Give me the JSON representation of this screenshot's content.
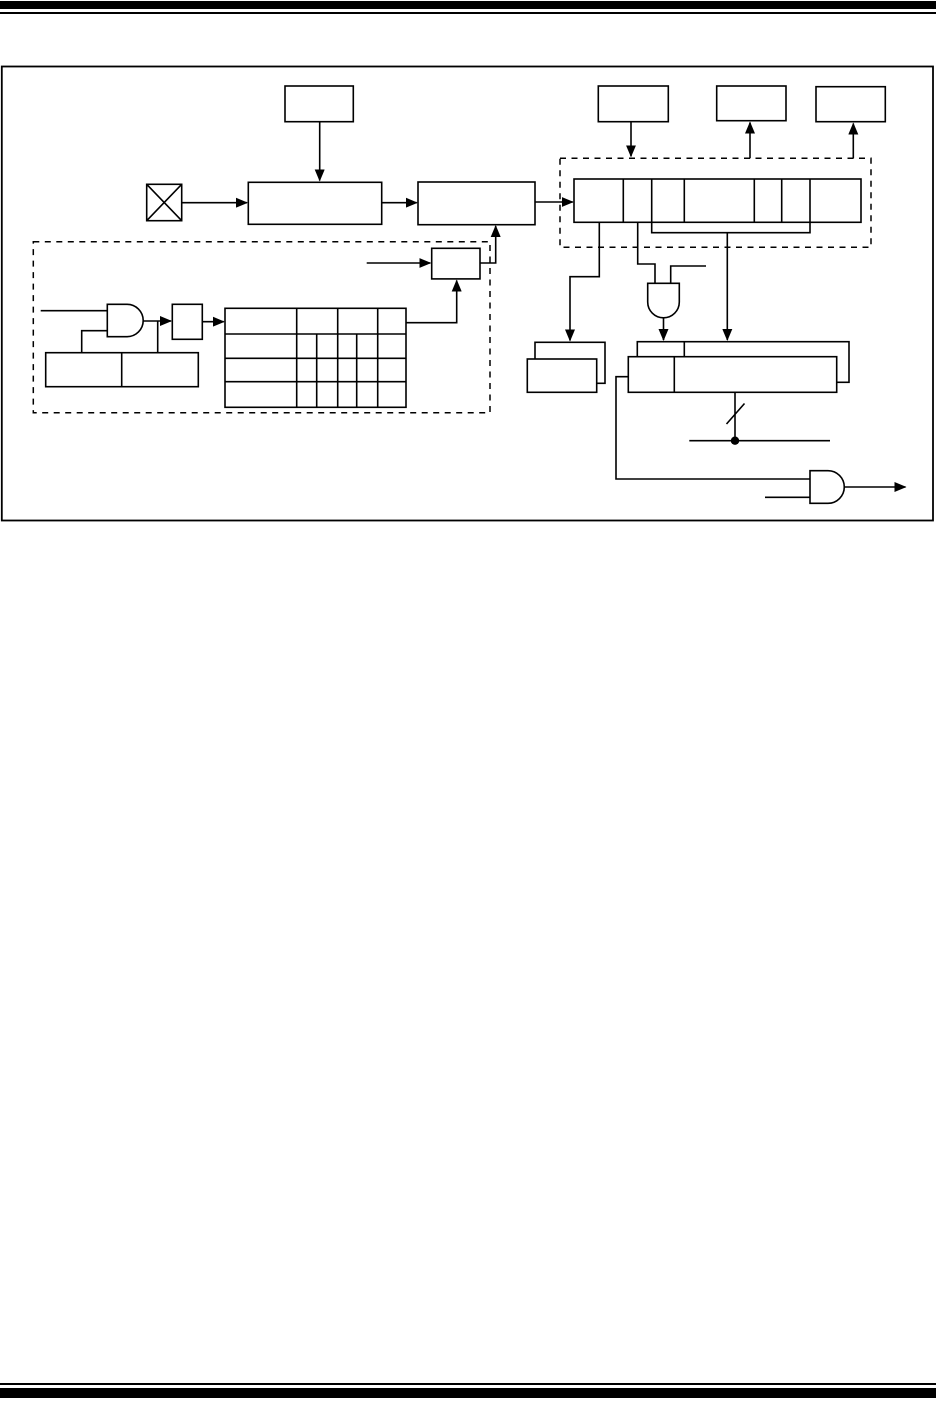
{
  "page": {
    "kind": "datasheet-figure-page",
    "visible_text": []
  },
  "colors": {
    "page_background": "#ffffff",
    "line_color": "#000000",
    "rule_color": "#000000"
  },
  "header": {
    "rules": [
      "thick-bar",
      "thin-rule"
    ]
  },
  "footer": {
    "rules": [
      "thin-rule",
      "thick-bar"
    ]
  },
  "figure": {
    "type": "block-diagram",
    "border": "solid-rectangle",
    "text_labels": [],
    "components": [
      {
        "name": "top-center-box",
        "type": "block"
      },
      {
        "name": "crystal-symbol",
        "type": "crossed-box"
      },
      {
        "name": "stage1-box",
        "type": "block"
      },
      {
        "name": "stage2-box",
        "type": "block"
      },
      {
        "name": "top-right-box-1",
        "type": "block"
      },
      {
        "name": "top-right-box-2",
        "type": "block"
      },
      {
        "name": "top-right-box-3",
        "type": "block"
      },
      {
        "name": "register-dashed-group",
        "type": "dashed-boundary"
      },
      {
        "name": "bit-register",
        "type": "segmented-register",
        "segments": 7
      },
      {
        "name": "control-dashed-group",
        "type": "dashed-boundary"
      },
      {
        "name": "and-gate-left",
        "type": "and-gate"
      },
      {
        "name": "latch-box",
        "type": "block"
      },
      {
        "name": "two-field-box",
        "type": "split-block",
        "fields": 2
      },
      {
        "name": "divider-table",
        "type": "grid",
        "rows": 4
      },
      {
        "name": "sync-box",
        "type": "block"
      },
      {
        "name": "and-gate-middle",
        "type": "and-gate"
      },
      {
        "name": "register-pair-left",
        "type": "stacked-registers",
        "boxes": 2
      },
      {
        "name": "register-pair-right",
        "type": "stacked-registers",
        "boxes": 2
      },
      {
        "name": "bus-width-slash",
        "type": "bus-marker"
      },
      {
        "name": "wire-junction-dot",
        "type": "junction"
      },
      {
        "name": "and-gate-output",
        "type": "and-gate"
      }
    ]
  }
}
